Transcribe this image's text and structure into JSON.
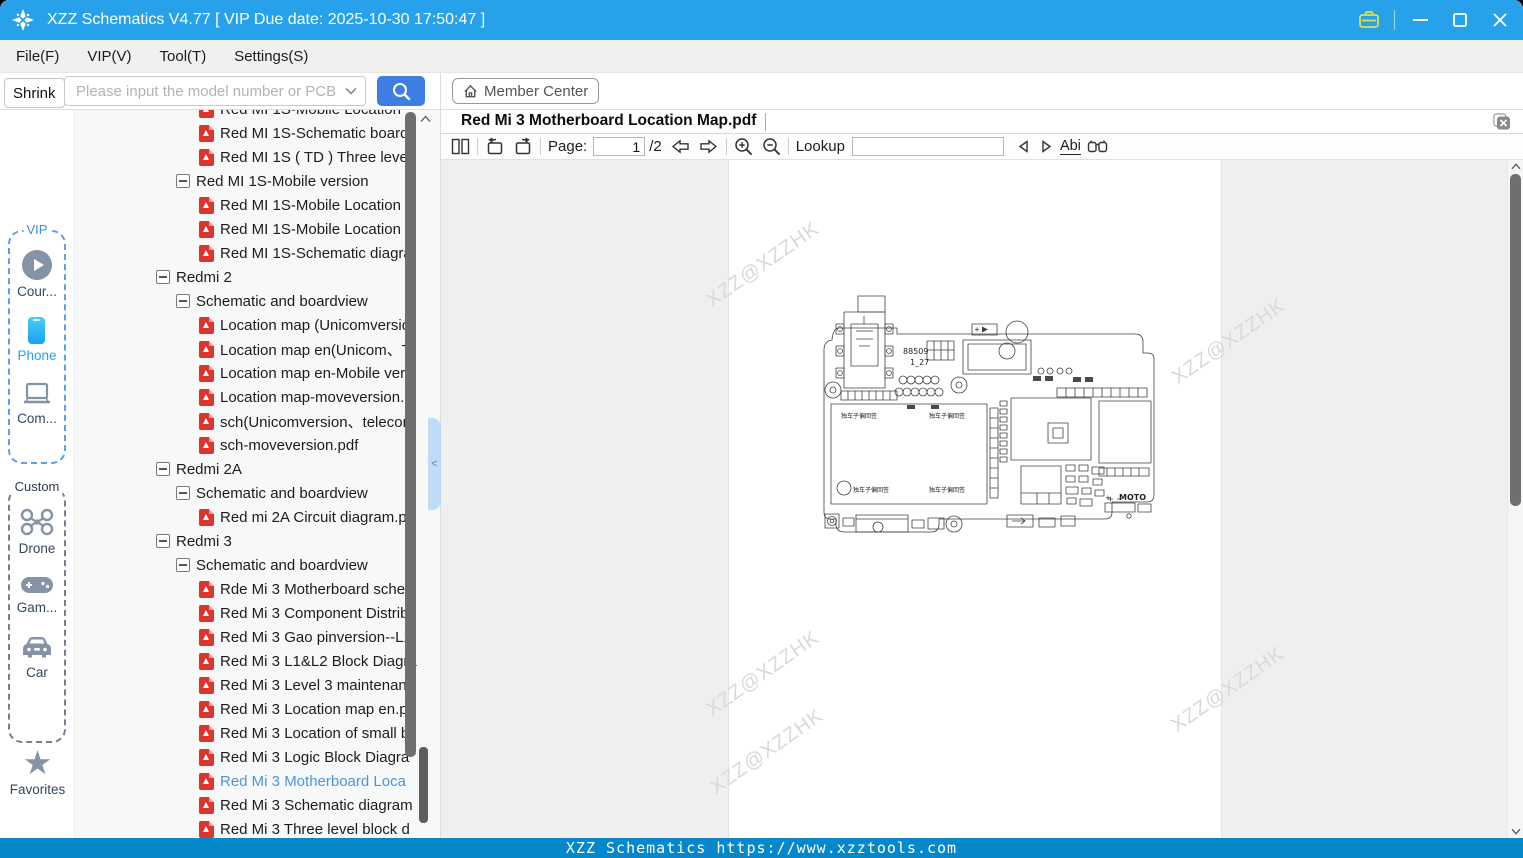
{
  "window": {
    "title": "XZZ Schematics V4.77 [ VIP Due date: 2025-10-30 17:50:47 ]"
  },
  "menu": {
    "items": [
      "File(F)",
      "VIP(V)",
      "Tool(T)",
      "Settings(S)"
    ]
  },
  "search": {
    "shrink_label": "Shrink",
    "placeholder": "Please input the model number or PCB"
  },
  "member_center": {
    "label": "Member Center"
  },
  "sidebar": {
    "vip_group_label": "VIP",
    "custom_group_label": "Custom",
    "courses_label": "Cour...",
    "phone_label": "Phone",
    "computer_label": "Com...",
    "drone_label": "Drone",
    "game_label": "Gam...",
    "car_label": "Car",
    "favorites_label": "Favorites"
  },
  "tree": {
    "items": [
      {
        "type": "pdf",
        "level": 3,
        "label": "Red MI 1S-Mobile Location"
      },
      {
        "type": "pdf",
        "level": 3,
        "label": "Red MI 1S-Schematic board"
      },
      {
        "type": "pdf",
        "level": 3,
        "label": "Red MI 1S ( TD ) Three level"
      },
      {
        "type": "group",
        "level": 2,
        "label": "Red MI 1S-Mobile version"
      },
      {
        "type": "pdf",
        "level": 3,
        "label": "Red MI 1S-Mobile Location r"
      },
      {
        "type": "pdf",
        "level": 3,
        "label": "Red MI 1S-Mobile Location r"
      },
      {
        "type": "pdf",
        "level": 3,
        "label": "Red MI 1S-Schematic diagra"
      },
      {
        "type": "group",
        "level": 1,
        "label": "Redmi 2"
      },
      {
        "type": "group",
        "level": 2,
        "label": "Schematic and boardview"
      },
      {
        "type": "pdf",
        "level": 3,
        "label": "Location map (Unicomversio"
      },
      {
        "type": "pdf",
        "level": 3,
        "label": "Location map en(Unicom、T"
      },
      {
        "type": "pdf",
        "level": 3,
        "label": "Location map en-Mobile ver"
      },
      {
        "type": "pdf",
        "level": 3,
        "label": "Location map-moveversion.p"
      },
      {
        "type": "pdf",
        "level": 3,
        "label": "sch(Unicomversion、telecom"
      },
      {
        "type": "pdf",
        "level": 3,
        "label": "sch-moveversion.pdf"
      },
      {
        "type": "group",
        "level": 1,
        "label": "Redmi 2A"
      },
      {
        "type": "group",
        "level": 2,
        "label": "Schematic and boardview"
      },
      {
        "type": "pdf",
        "level": 3,
        "label": "Red mi 2A Circuit diagram.pd"
      },
      {
        "type": "group",
        "level": 1,
        "label": "Redmi 3"
      },
      {
        "type": "group",
        "level": 2,
        "label": "Schematic and boardview"
      },
      {
        "type": "pdf",
        "level": 3,
        "label": "Rde Mi 3 Motherboard scher"
      },
      {
        "type": "pdf",
        "level": 3,
        "label": "Red Mi 3 Component Distrib"
      },
      {
        "type": "pdf",
        "level": 3,
        "label": "Red Mi 3 Gao pinversion--L1"
      },
      {
        "type": "pdf",
        "level": 3,
        "label": "Red Mi 3 L1&L2 Block Diagra"
      },
      {
        "type": "pdf",
        "level": 3,
        "label": "Red Mi 3 Level 3 maintenanc"
      },
      {
        "type": "pdf",
        "level": 3,
        "label": "Red Mi 3 Location map en.pd"
      },
      {
        "type": "pdf",
        "level": 3,
        "label": "Red Mi 3 Location of small b"
      },
      {
        "type": "pdf",
        "level": 3,
        "label": "Red Mi 3 Logic Block Diagra"
      },
      {
        "type": "pdf",
        "level": 3,
        "label": "Red Mi 3 Motherboard Loca",
        "selected": true
      },
      {
        "type": "pdf",
        "level": 3,
        "label": "Red Mi 3 Schematic diagram"
      },
      {
        "type": "pdf",
        "level": 3,
        "label": "Red Mi 3 Three level block d"
      }
    ]
  },
  "viewer": {
    "tab_title": "Red Mi 3 Motherboard Location Map.pdf",
    "toolbar": {
      "page_label": "Page:",
      "page_value": "1",
      "page_total": "/2",
      "lookup_label": "Lookup",
      "abi_label": "Abi"
    },
    "watermark": "XZZ@XZZHK",
    "board": {
      "ref_a": "88509",
      "ref_b": "1_27",
      "plus": "+",
      "moto": "MOTO",
      "area_label": "独车子偏回签"
    }
  },
  "status_bar": {
    "text": "XZZ Schematics https://www.xzztools.com"
  }
}
